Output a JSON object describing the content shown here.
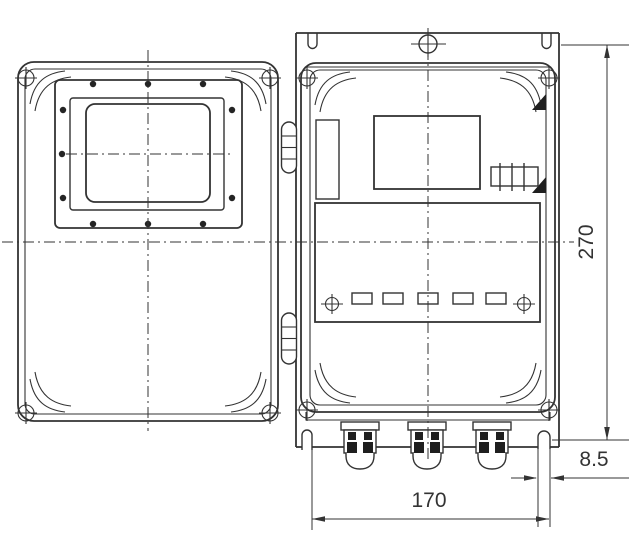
{
  "drawing": {
    "background_color": "#ffffff",
    "line_color": "#333333",
    "dimension_labels": {
      "height": "270",
      "width": "170",
      "slot": "8.5"
    }
  }
}
